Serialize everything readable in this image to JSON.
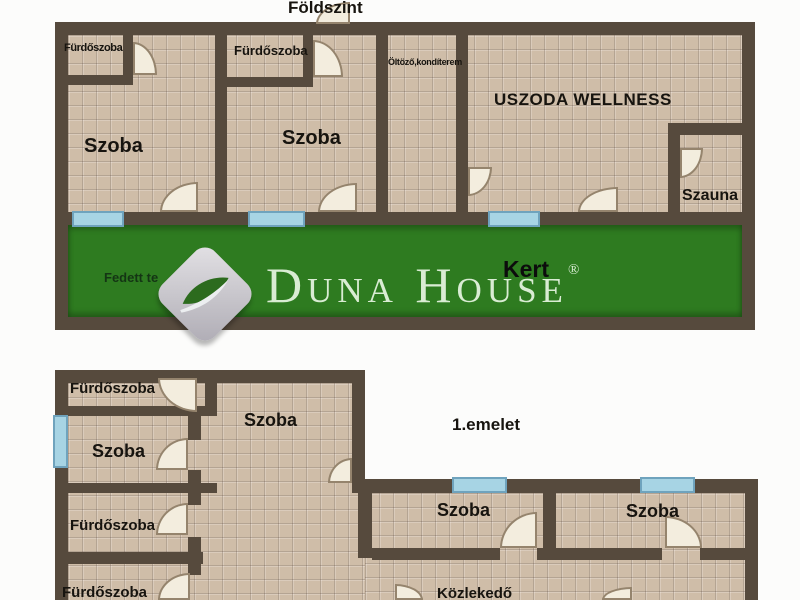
{
  "floor0": {
    "title": "Földszint",
    "bath1": "Fürdőszoba",
    "szoba1": "Szoba",
    "bath2": "Fürdőszoba",
    "szoba2": "Szoba",
    "dressing": "Öltöző,kondíterem",
    "pool": "USZODA WELLNESS",
    "sauna": "Szauna",
    "garden": "Kert",
    "terrace": "Fedett te"
  },
  "floor1": {
    "title": "1.emelet",
    "bath_top": "Fürdőszoba",
    "szoba_left": "Szoba",
    "szoba_center": "Szoba",
    "bath_mid": "Fürdőszoba",
    "bath_bottom": "Fürdőszoba",
    "szoba_a": "Szoba",
    "szoba_b": "Szoba",
    "hall": "Közlekedő"
  },
  "watermark": {
    "brand": "Duna House",
    "registered": "®"
  },
  "colors": {
    "wall": "#564a3d",
    "floor_tile": "#cfbda8",
    "garden_green": "#2e7b20",
    "window_blue": "#a7d4e4",
    "door_leaf": "#f3edde",
    "brand_text": "#d9ecd3"
  }
}
